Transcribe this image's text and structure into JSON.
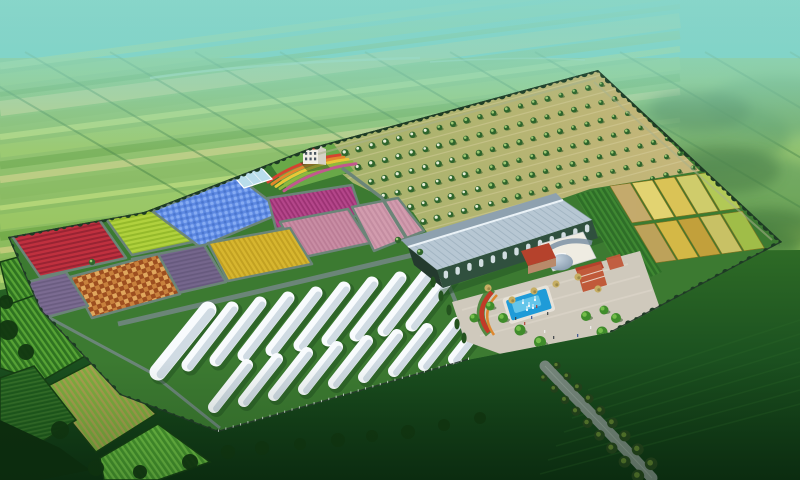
{
  "scene": {
    "alt": "Aerial 3D rendering of an agricultural eco-park: quilt of colorful crop plots, orchard rows, a large glass greenhouse, white hoop greenhouses, a visitor plaza with blue pool and red-roofed buildings, a tree-lined entry road, all surrounded by hazy green farmland"
  },
  "palette": {
    "sky_top": "#49c2c4",
    "sky_mid": "#74d0c6",
    "sky_low": "#9cdab6",
    "sky_grass": "#abdc9e",
    "far_base": "#8cbb5c",
    "hedge": "#33702f",
    "river": "#c8e7d4",
    "far_cycle": [
      "#bad973",
      "#9cc75f",
      "#6fa844",
      "#c9cd7e",
      "#87b757"
    ],
    "terrain_blob1": "#4e8a46",
    "terrain_blob2": "#35682f",
    "haze": "#79d2cb",
    "haze2": "#a5ddc6",
    "fg_top": "#2e6b26",
    "fg_mid": "#1c5220",
    "fg_bot": "#0d3012",
    "fg_line": "#2e6b2a",
    "fg_tree": "#123711",
    "fg_dark_mass": "#0e2f0f",
    "complex_ground": "#3c7a31",
    "path": "#6b8578",
    "wall_line": "#24372d",
    "wall_tree": "#1d3b24",
    "fence": "#dfe8e0",
    "inner_road": "#a9b18b",
    "orchard_l": "#a2b269",
    "orchard_r": "#c7b67b",
    "orchard_row": "#d9d0a0",
    "tree_dark": "#2f652c",
    "tree_blossom": "#e7efd7",
    "tree_light": "#9dc873",
    "tree_shadow": "#27501e",
    "glasshouse": "#b9ddeb",
    "glasshouse_frame": "#ffffff",
    "office_front": "#f2efe6",
    "office_side": "#d5d2c6",
    "office_red": "#b5422c",
    "office_win": "#4a5560",
    "garden_green": "#69a848",
    "gh_roof": "#b7c7d3",
    "gh_roof_far": "#8ea1af",
    "gh_rib": "#8fa4b3",
    "gh_ridge": "#eaf2f7",
    "gh_wall": "#30503e",
    "gh_end": "#243a2e",
    "gh_arch": "#dfe9ee",
    "gh_shadow": "#1c4a20",
    "tunnel_top": "#f8fbfd",
    "tunnel_side": "#ccd8e1",
    "tunnel_shadow": "#16401a",
    "plaza": "#cfc9bc",
    "plaza_light": "#ded8cb",
    "deck": "#e8e4da",
    "pool": "#1f9bd8",
    "pool_light": "#7cd3f0",
    "white": "#ffffff",
    "bed_green": "#3e7e2e",
    "flower_red": "#c23a28",
    "flower_orange": "#dd8830",
    "dome_hi": "#c6d4e0",
    "dome_lo": "#7d92a5",
    "bldg_white": "#efece2",
    "bldg_red": "#b5422c",
    "bldg_red2": "#c05a3a",
    "bldg_tan": "#b98a6a",
    "plaza_tree": "#3f8c2b",
    "plaza_tree_hi": "#74bd4a",
    "shrub": "#c6ae63",
    "shrub_dark": "#8a7a3e",
    "cypress": "#24531f",
    "road": "#75857b",
    "road_tree": "#5a7a2e",
    "road_tree_dark": "#24421c",
    "person": [
      "#333a40",
      "#b03a2e",
      "#2e4a8c",
      "#f2f2f2"
    ]
  },
  "plots": [
    {
      "name": "red",
      "base": "#c0303e",
      "row": "#992433",
      "angle": -12,
      "pitch": 4.5,
      "kind": "rows"
    },
    {
      "name": "chartreuse",
      "base": "#b1d13d",
      "row": "#95ba2b",
      "angle": -12,
      "pitch": 4.5,
      "kind": "rows"
    },
    {
      "name": "blue",
      "base": "#5d89e2",
      "row": "#4a76cf",
      "dot": "#85abf2",
      "angle": -12,
      "pitch": 6,
      "kind": "dots"
    },
    {
      "name": "magenta",
      "base": "#b4468a",
      "row": "#9b3273",
      "angle": 58,
      "pitch": 4,
      "kind": "rows"
    },
    {
      "name": "pink_left",
      "base": "#c98da4",
      "row": "#bb7d96",
      "angle": 58,
      "pitch": 4,
      "kind": "rows"
    },
    {
      "name": "pink_right",
      "base": "#d29cae",
      "row": "#c48da1",
      "angle": 58,
      "pitch": 4.5,
      "kind": "rows"
    },
    {
      "name": "yellow",
      "base": "#d7b62f",
      "row": "#c2a122",
      "angle": 58,
      "pitch": 4.5,
      "kind": "rows"
    },
    {
      "name": "purple",
      "base": "#75668c",
      "row": "#675a7e",
      "angle": -12,
      "pitch": 4,
      "kind": "rows"
    },
    {
      "name": "orange",
      "base": "#c8813c",
      "row": "#9d4e20",
      "alt": "#e0a75c",
      "angle": -20,
      "pitch": 9,
      "kind": "checks"
    },
    {
      "name": "purple_small",
      "base": "#7b6b91",
      "row": "#6b5d81",
      "angle": -12,
      "pitch": 4,
      "kind": "rows"
    },
    {
      "name": "crop_rows",
      "base": "#2e6e28",
      "row": "#3f8832",
      "angle": 58,
      "pitch": 5,
      "kind": "rows"
    },
    {
      "name": "fg_a",
      "base": "#2f7321",
      "row": "#57a335",
      "angle": 55,
      "pitch": 5,
      "kind": "rows"
    },
    {
      "name": "fg_b",
      "base": "#7fae3f",
      "row": "#a8a050",
      "angle": 55,
      "pitch": 5,
      "kind": "rows"
    },
    {
      "name": "fg_c",
      "base": "#1f5a1d",
      "row": "#346f28",
      "angle": -12,
      "pitch": 4,
      "kind": "rows"
    },
    {
      "name": "fg_d",
      "base": "#49992f",
      "row": "#6fbf45",
      "angle": 55,
      "pitch": 5,
      "kind": "rows"
    }
  ],
  "wheat": {
    "rows": 2,
    "cols": 5,
    "colors": [
      "#c9ac6e",
      "#e8d674",
      "#dfc658",
      "#d4cf6e",
      "#b6cc58",
      "#c2a45c",
      "#d9ba48",
      "#c7a23c",
      "#cdc468",
      "#a4bf4a"
    ]
  },
  "hoops": {
    "back": 10,
    "front": 9
  },
  "garden_bands": [
    "#d64330",
    "#e2882c",
    "#e9c737",
    "#8fb83c",
    "#c2588e"
  ]
}
